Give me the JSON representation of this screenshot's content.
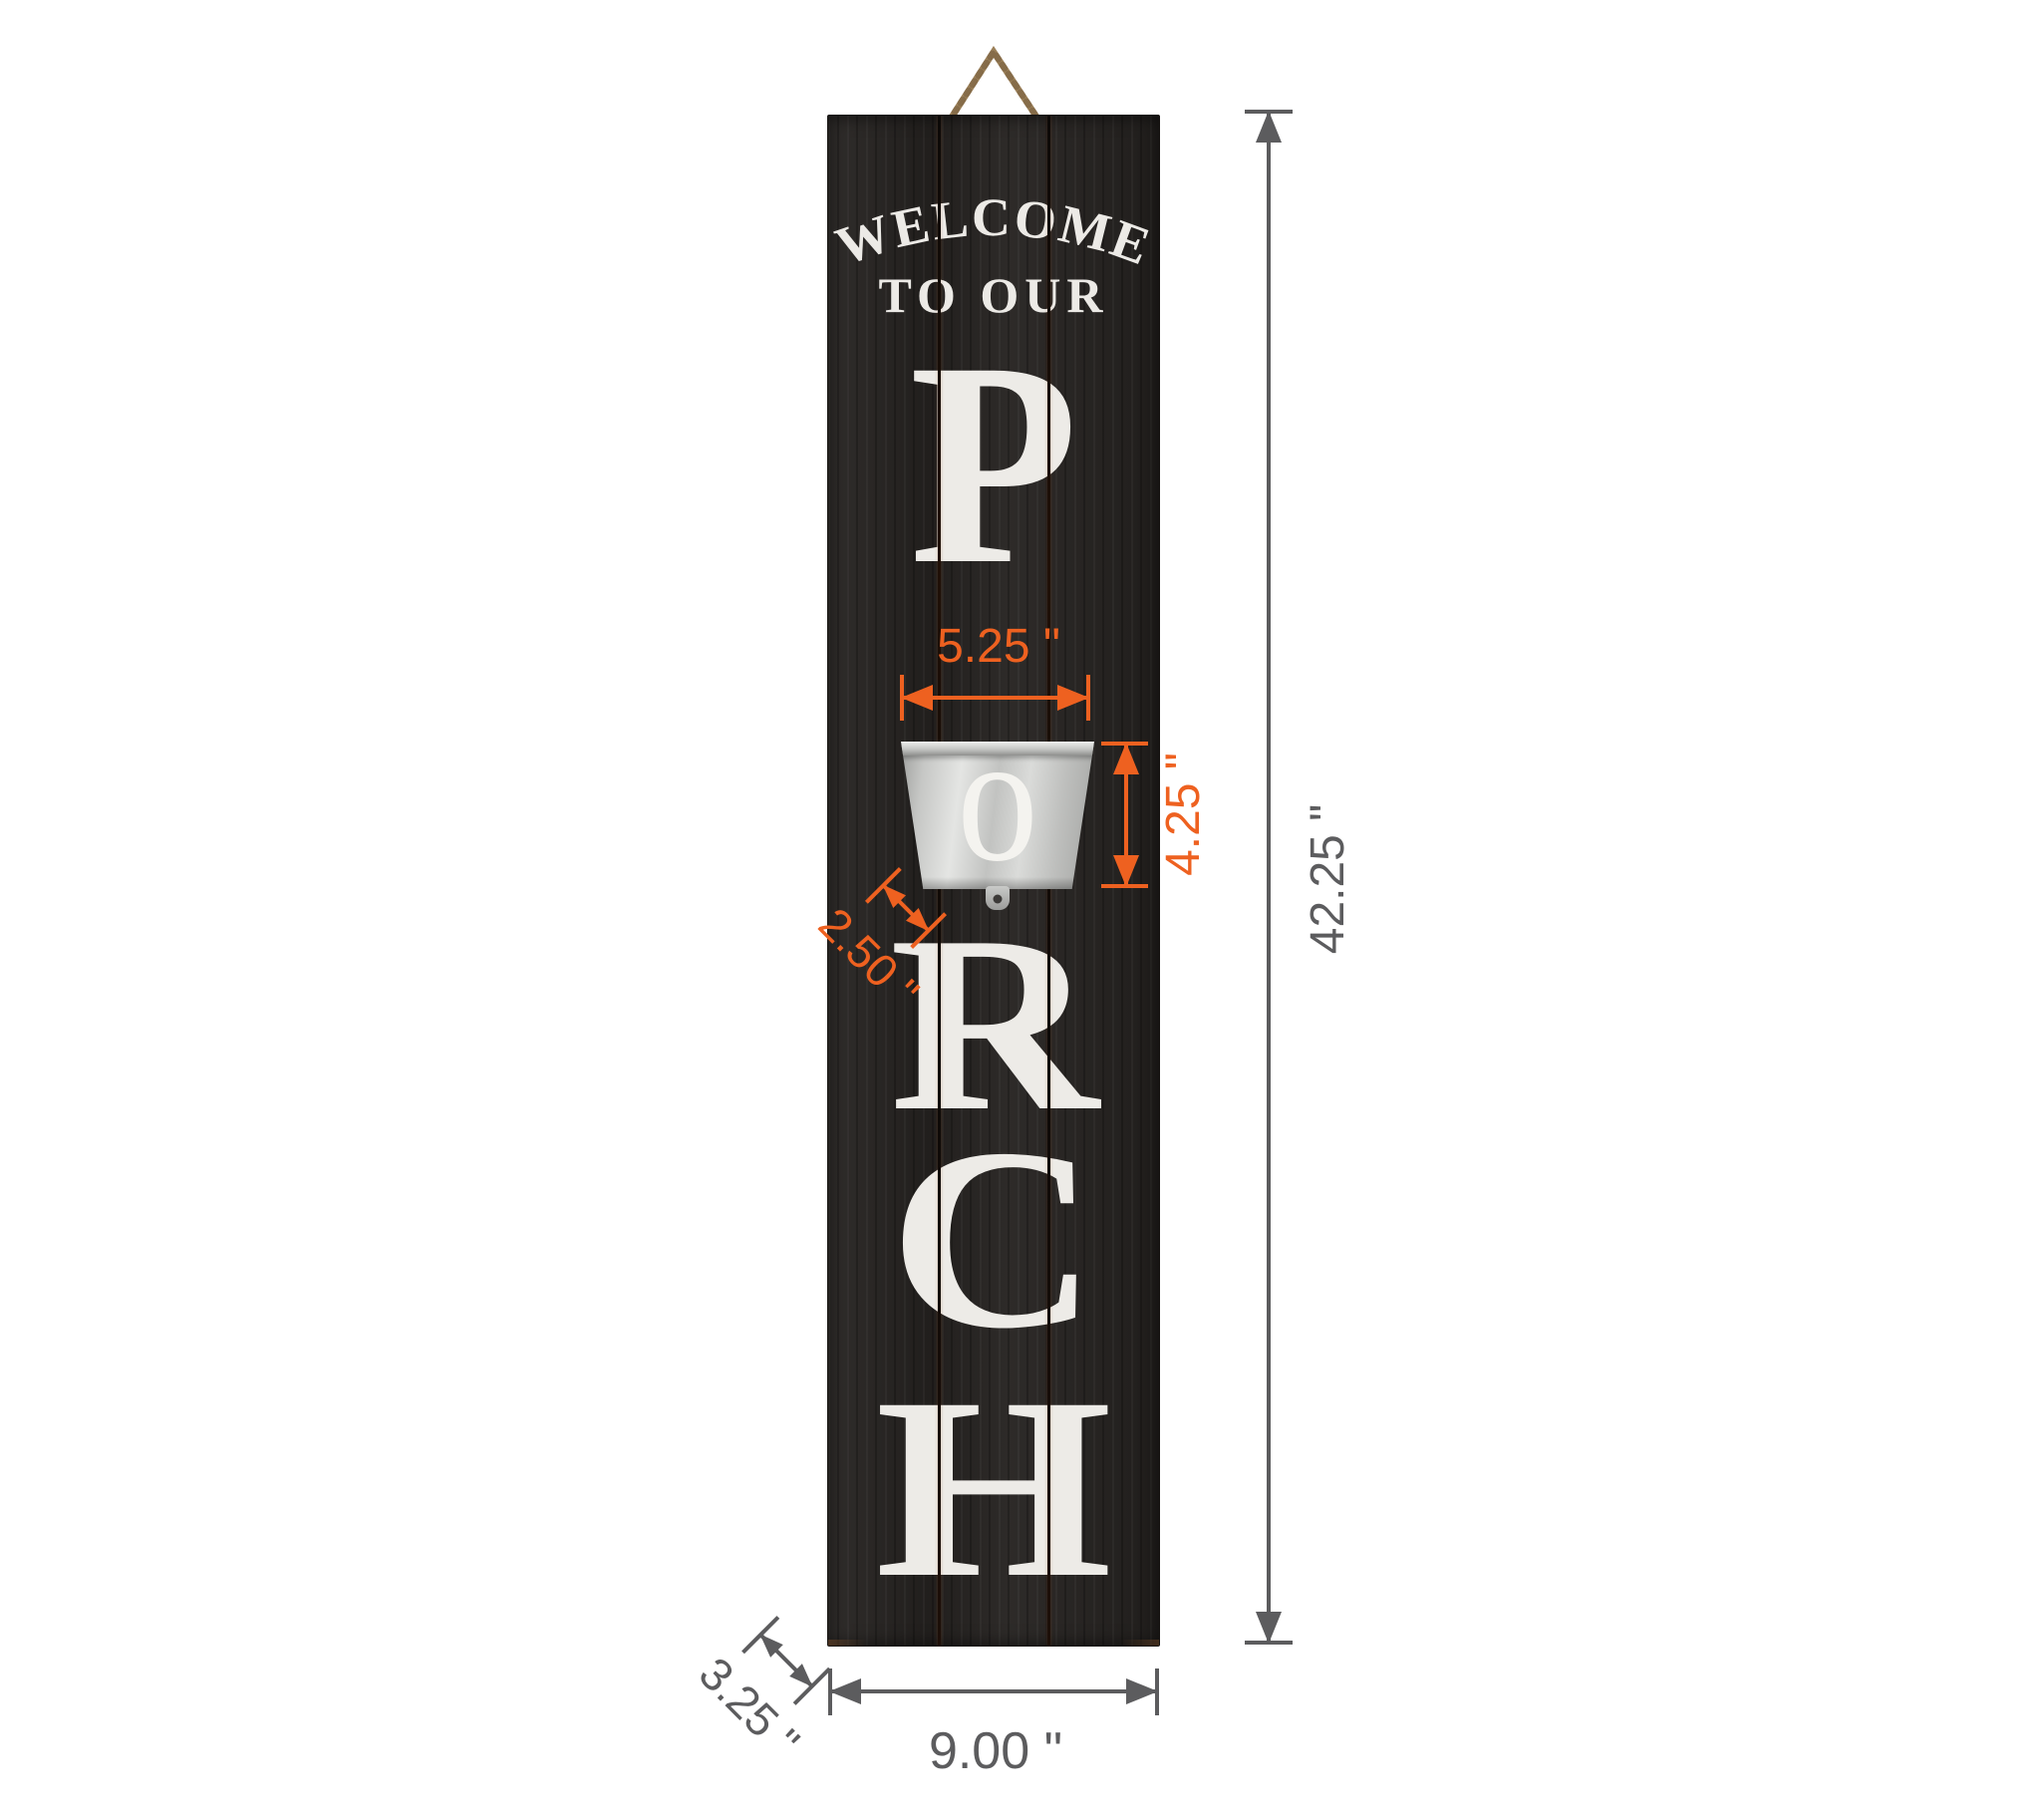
{
  "colors": {
    "dimension_accent_orange": "#EE6120",
    "dimension_neutral_gray": "#5C5C5E",
    "board_black": "#252220",
    "lettering_white": "#ECEAE6",
    "bucket_silver": "#C9CAC8",
    "rope_tan": "#9A7F58"
  },
  "sign": {
    "welcome_line": "WELCOME",
    "to_our_line": "TO OUR",
    "letters": [
      "P",
      "R",
      "C",
      "H"
    ],
    "bucket_letter": "o"
  },
  "dims": {
    "planter_width": "5.25 \"",
    "planter_height": "4.25 \"",
    "planter_depth": "2.50 \"",
    "sign_height": "42.25 \"",
    "sign_width": "9.00 \"",
    "sign_depth": "3.25 \""
  }
}
